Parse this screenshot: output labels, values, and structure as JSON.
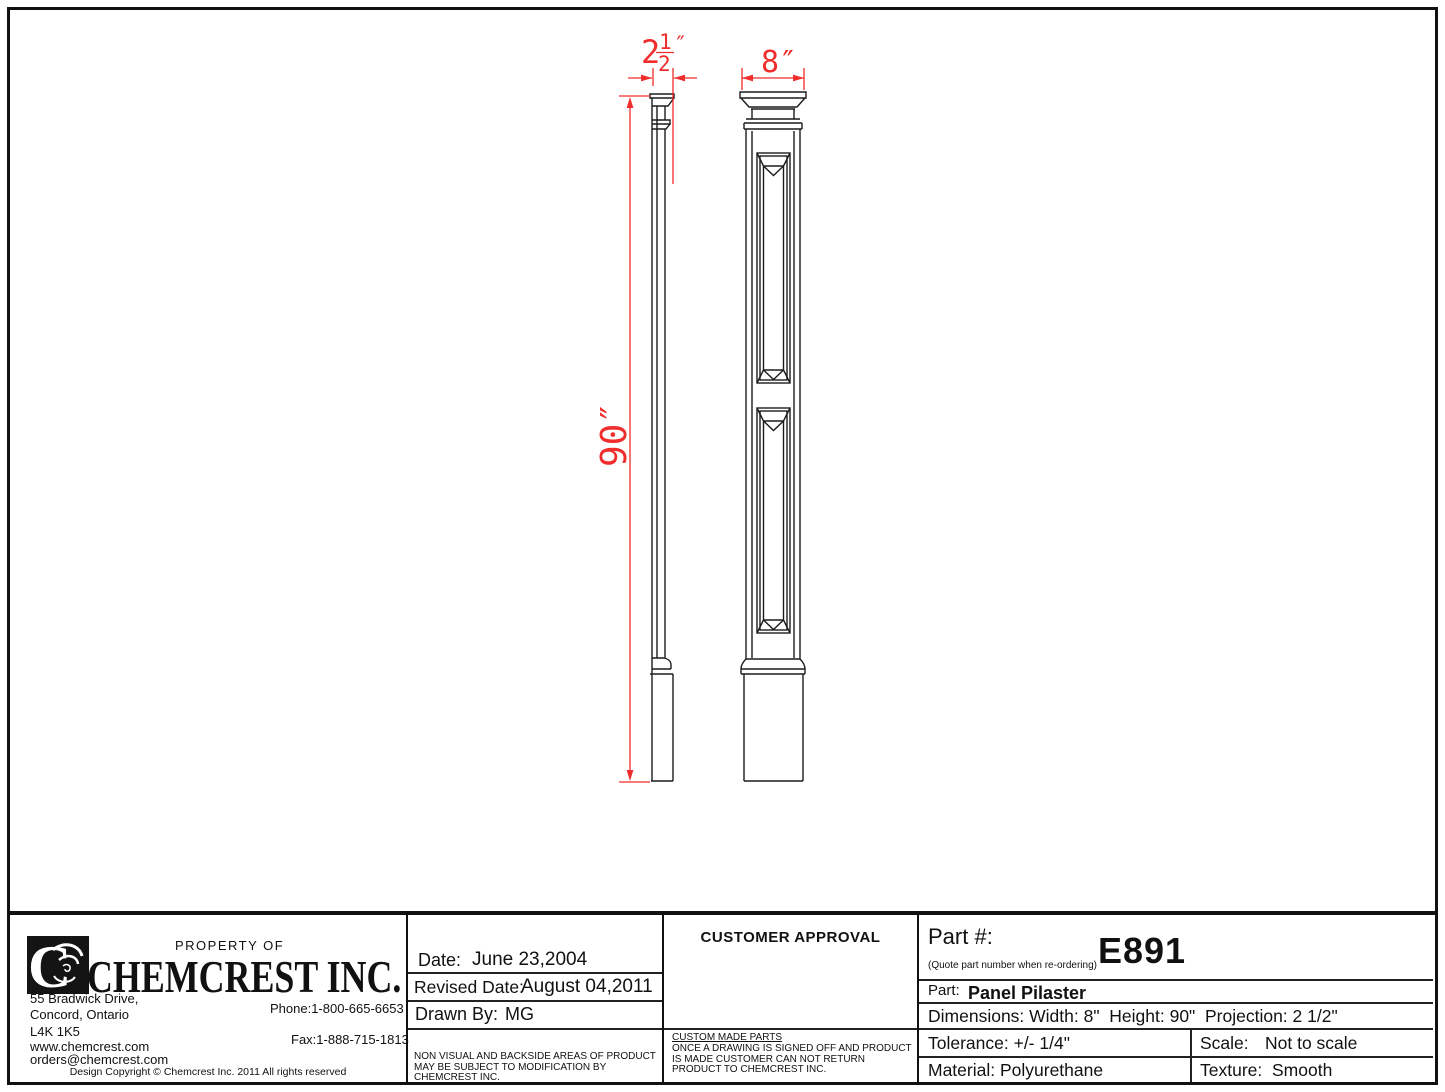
{
  "drawing": {
    "projection_whole": "2",
    "projection_numerator": "1",
    "projection_denominator": "2",
    "projection_unit": "″",
    "width_label": "8″",
    "height_label": "90″"
  },
  "title_block": {
    "property_of": "PROPERTY OF",
    "company_name": "CHEMCREST INC.",
    "address1": "55 Bradwick Drive,",
    "address2": "Concord, Ontario",
    "postal": "L4K 1K5",
    "website": "www.chemcrest.com",
    "email": "orders@chemcrest.com",
    "phone": "Phone:1-800-665-6653",
    "fax": "Fax:1-888-715-1813",
    "copyright": "Design Copyright © Chemcrest Inc. 2011 All rights reserved",
    "date_label": "Date:",
    "date_value": "June 23,2004",
    "revised_label": "Revised Date:",
    "revised_value": "August 04,2011",
    "drawn_label": "Drawn By:",
    "drawn_value": "MG",
    "note_text": "NON VISUAL AND BACKSIDE AREAS OF PRODUCT MAY BE SUBJECT TO MODIFICATION BY CHEMCREST INC.",
    "approval_title": "CUSTOMER APPROVAL",
    "custom_parts_title": "CUSTOM MADE PARTS",
    "custom_parts_text": "ONCE A DRAWING IS SIGNED OFF AND PRODUCT IS MADE CUSTOMER CAN NOT RETURN PRODUCT TO CHEMCREST INC.",
    "part_number_label": "Part #:",
    "part_number_hint": "(Quote part number when re-ordering)",
    "part_number": "E891",
    "part_label": "Part:",
    "part_name": "Panel Pilaster",
    "dimensions_text": "Dimensions: Width: 8\"  Height: 90\"  Projection: 2 1/2\"",
    "tolerance_text": "Tolerance: +/- 1/4\"",
    "scale_label": "Scale:",
    "scale_value": "Not to scale",
    "material_text": "Material: Polyurethane",
    "texture_label": "Texture:",
    "texture_value": "Smooth"
  },
  "colors": {
    "line": "#1c1c1c",
    "dimension": "#f02d2d"
  }
}
